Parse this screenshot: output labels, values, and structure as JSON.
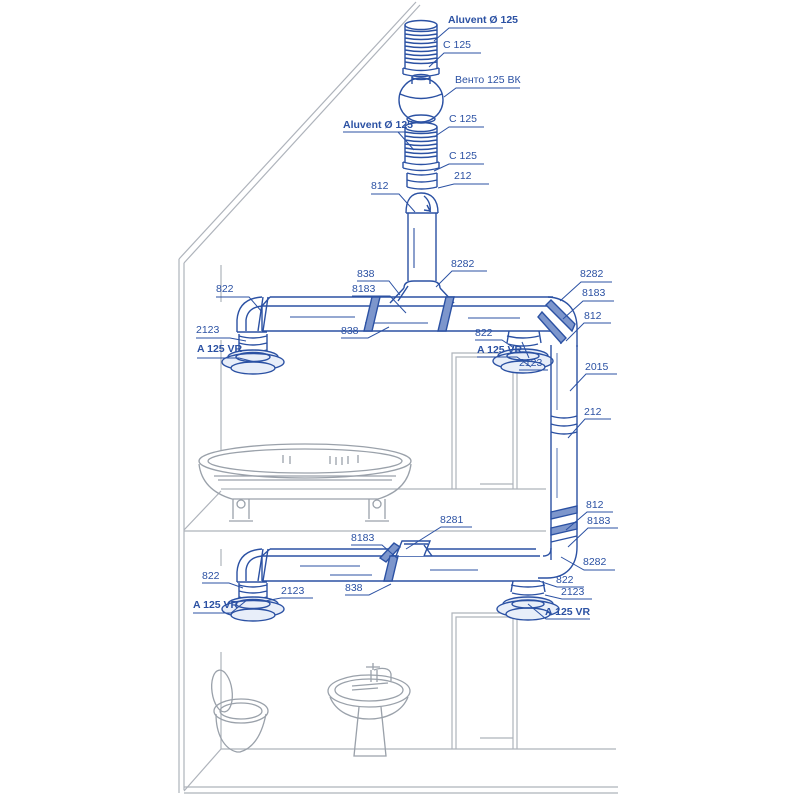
{
  "diagram": {
    "kind": "house-cutaway-ventilation-installation",
    "colors": {
      "duct_blue": "#2b51a3",
      "label_blue": "#2b51a3",
      "outline_gray": "#aeb3bb",
      "fixture_gray": "#9aa1aa",
      "band_fill": "#7d96cc",
      "background": "#ffffff"
    },
    "fixtures": [
      "bathtub-icon",
      "toilet-icon",
      "pedestal-sink-icon",
      "door-frame",
      "roof-line"
    ],
    "labels": [
      {
        "text": "Aluvent Ø 125"
      },
      {
        "text": "C 125"
      },
      {
        "text": "Венто 125 ВК"
      },
      {
        "text": "C 125"
      },
      {
        "text": "Aluvent Ø 125"
      },
      {
        "text": "C 125"
      },
      {
        "text": "212"
      },
      {
        "text": "812"
      },
      {
        "text": "822"
      },
      {
        "text": "838"
      },
      {
        "text": "8183"
      },
      {
        "text": "8282"
      },
      {
        "text": "838"
      },
      {
        "text": "2123"
      },
      {
        "text": "A 125 VR"
      },
      {
        "text": "822"
      },
      {
        "text": "A 125 VR"
      },
      {
        "text": "2123"
      },
      {
        "text": "8282"
      },
      {
        "text": "8183"
      },
      {
        "text": "812"
      },
      {
        "text": "2015"
      },
      {
        "text": "212"
      },
      {
        "text": "812"
      },
      {
        "text": "8183"
      },
      {
        "text": "8281"
      },
      {
        "text": "8183"
      },
      {
        "text": "8282"
      },
      {
        "text": "822"
      },
      {
        "text": "2123"
      },
      {
        "text": "A 125 VR"
      },
      {
        "text": "822"
      },
      {
        "text": "838"
      },
      {
        "text": "2123"
      },
      {
        "text": "A 125 VR"
      }
    ]
  }
}
